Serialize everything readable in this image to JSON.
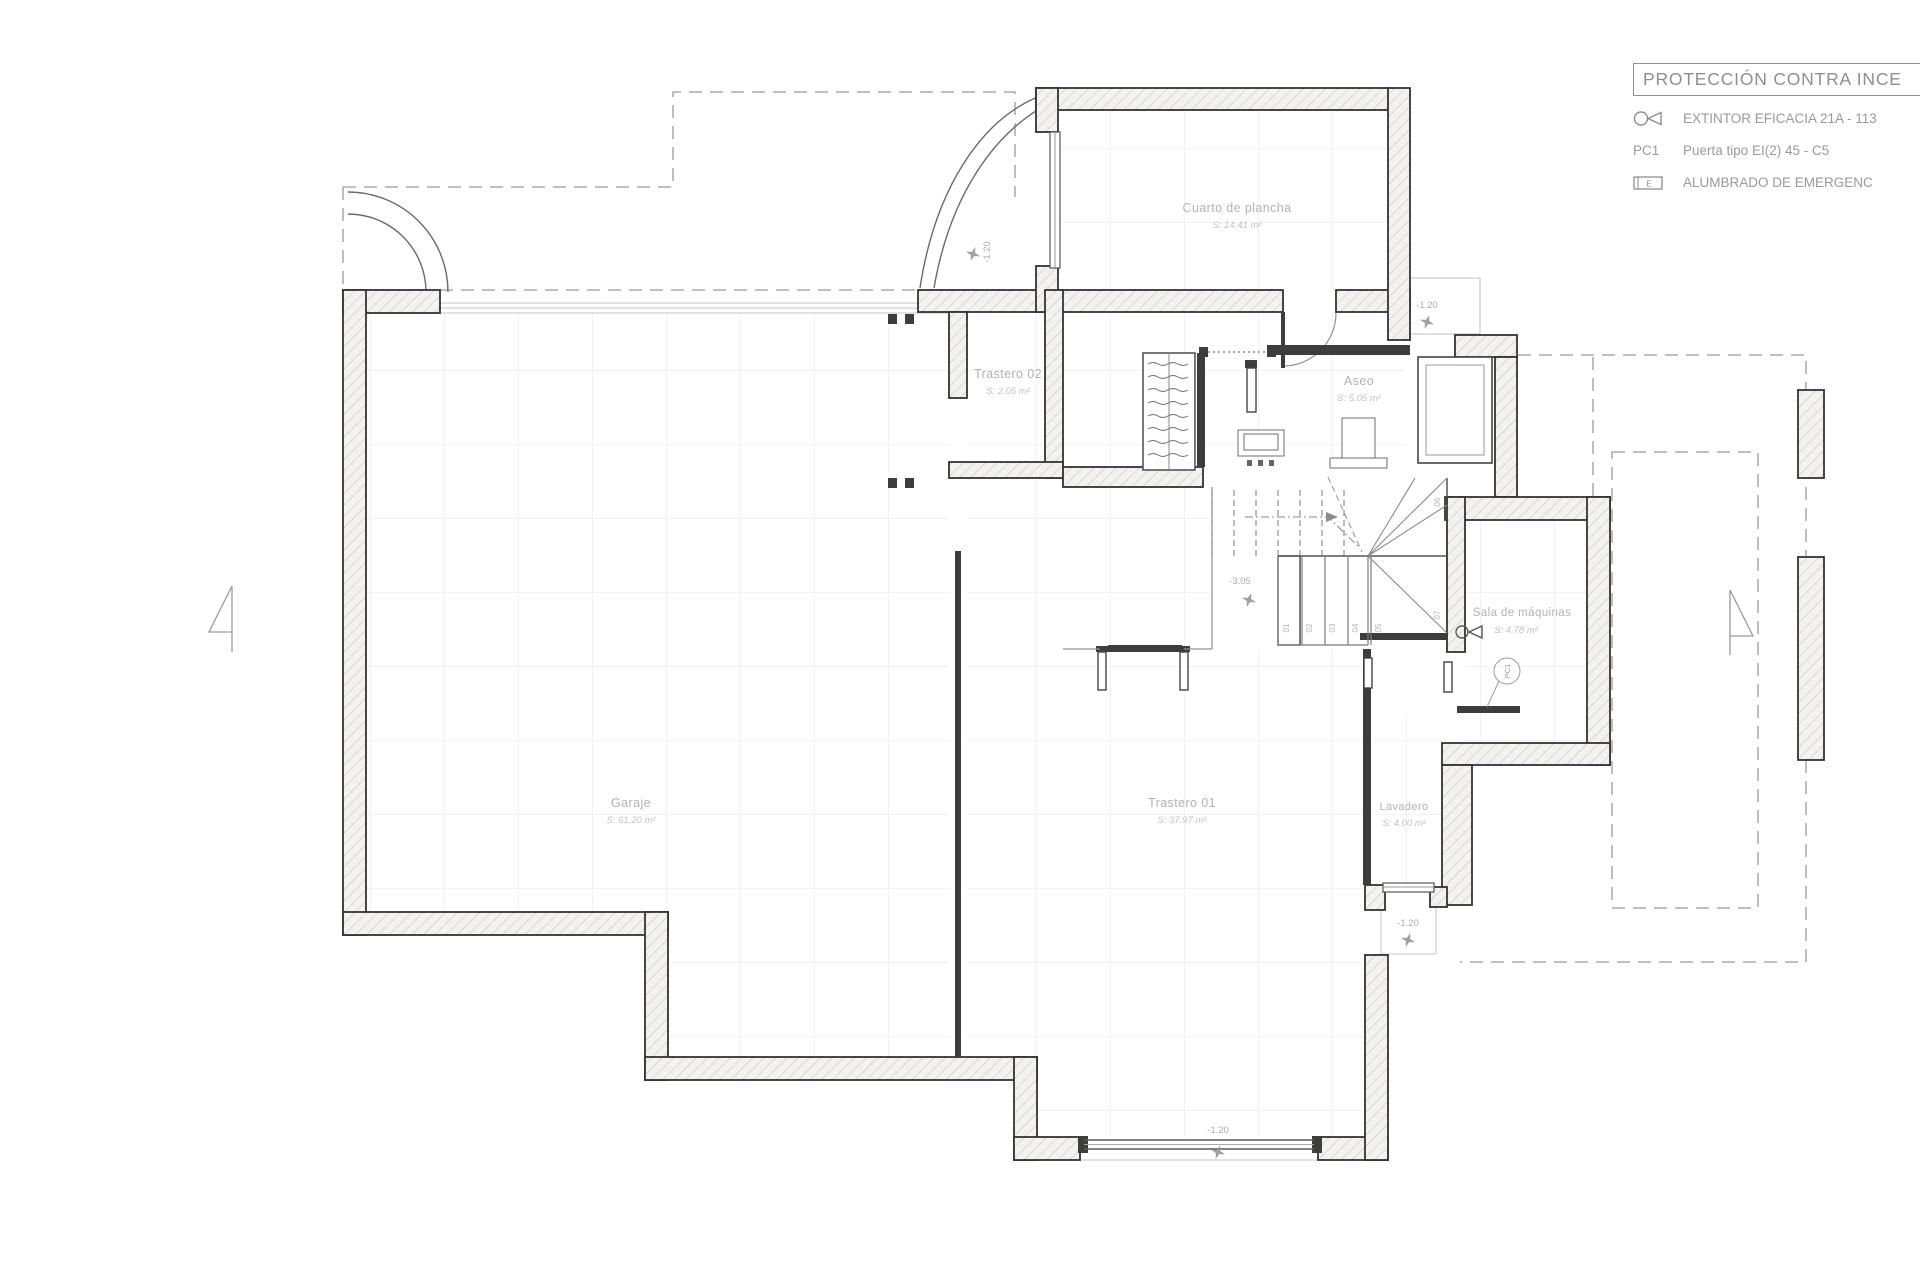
{
  "legend": {
    "title": "PROTECCIÓN CONTRA INCE",
    "items": [
      {
        "icon": "extinguisher-icon",
        "code": "",
        "label": "EXTINTOR EFICACIA 21A - 113"
      },
      {
        "icon": "",
        "code": "PC1",
        "label": "Puerta tipo EI(2) 45 - C5"
      },
      {
        "icon": "emergency-light-icon",
        "code": "E",
        "label": "ALUMBRADO DE EMERGENC"
      }
    ]
  },
  "rooms": [
    {
      "name": "Cuarto de plancha",
      "area": "S: 14.41 m²"
    },
    {
      "name": "Trastero 02",
      "area": "S: 2.05 m²"
    },
    {
      "name": "Aseo",
      "area": "S: 5.05 m²"
    },
    {
      "name": "Garaje",
      "area": "S: 61.20 m²"
    },
    {
      "name": "Trastero 01",
      "area": "S: 37.97 m²"
    },
    {
      "name": "Lavadero",
      "area": "S: 4.00 m²"
    },
    {
      "name": "Sala de máquinas",
      "area": "S: 4.78 m²"
    }
  ],
  "levels": {
    "arc_door": "-1.20",
    "lightwell": "-1.20",
    "stairs": "-3.05",
    "lavadero": "-1.20",
    "bottom_door": "-1.20"
  },
  "stairs": {
    "steps": [
      "01",
      "02",
      "03",
      "04",
      "05",
      "06",
      "07"
    ]
  },
  "door_ref": "PC1",
  "colors": {
    "wall": "#333333",
    "hatch": "#c4c4c4",
    "grid": "#e4e4e4",
    "text": "#9a9a9a"
  }
}
